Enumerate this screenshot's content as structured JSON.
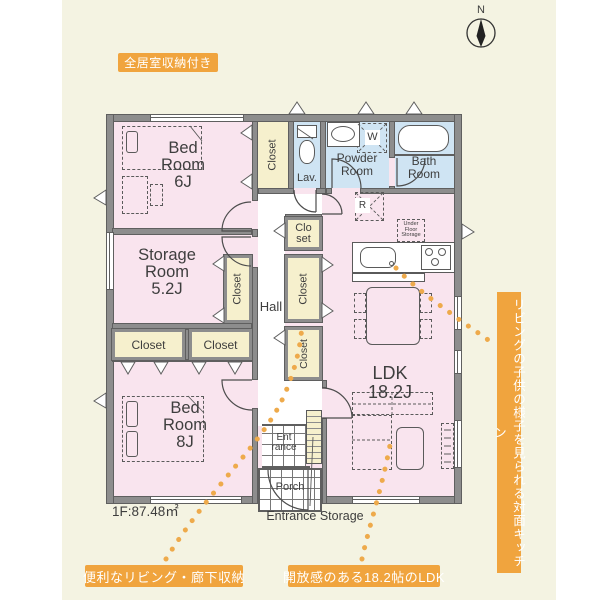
{
  "compass": {
    "label": "N"
  },
  "badges": {
    "top": {
      "text": "全居室収納付き"
    },
    "bottom_left": {
      "text": "便利なリビング・廊下収納"
    },
    "bottom_center": {
      "text": "開放感のある18.2帖のLDK"
    },
    "right_vertical": {
      "text": "リビングの子供の様子を見られる対面キッチン"
    }
  },
  "rooms": {
    "bed6": {
      "l1": "Bed",
      "l2": "Room",
      "l3": "6J"
    },
    "storage": {
      "l1": "Storage",
      "l2": "Room",
      "l3": "5.2J"
    },
    "bed8": {
      "l1": "Bed",
      "l2": "Room",
      "l3": "8J"
    },
    "ldk": {
      "l1": "LDK",
      "l2": "18.2J"
    },
    "hall": {
      "label": "Hall"
    },
    "lav": {
      "label": "Lav."
    },
    "powder": {
      "l1": "Powder",
      "l2": "Room"
    },
    "bath": {
      "l1": "Bath",
      "l2": "Room"
    },
    "entrance": {
      "l1": "Ent",
      "l2": "rance"
    },
    "porch": {
      "label": "Porch"
    },
    "entrance_storage": {
      "label": "Entrance Storage"
    }
  },
  "closets": {
    "closet": "Closet",
    "clo": "Clo",
    "set": "set"
  },
  "appliances": {
    "fridge": "R",
    "washer": "W",
    "under_floor": {
      "l1": "Under",
      "l2": "Floor",
      "l3": "Storage"
    }
  },
  "floor_info": {
    "area": "1F:87.48㎡"
  },
  "colors": {
    "background": "#f4f3e2",
    "room_pink": "#f9e4ee",
    "wet_blue": "#cfe4f3",
    "closet_cream": "#f6f0cd",
    "wall_gray": "#8d8d8d",
    "accent_orange": "#f0a43e"
  }
}
